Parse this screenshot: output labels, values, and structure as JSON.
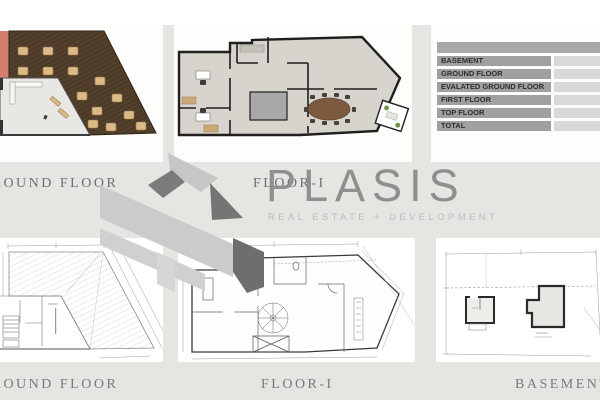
{
  "brand": {
    "name": "PLASIS",
    "tagline": "REAL ESTATE + DEVELOPMENT"
  },
  "top_row_labels": {
    "left": "GROUND FLOOR",
    "middle": "FLOOR-I"
  },
  "bottom_row_labels": {
    "left": "GROUND FLOOR",
    "middle": "FLOOR-I",
    "right": "BASEMENT"
  },
  "area_table": {
    "header": "",
    "rows": [
      {
        "label": "BASEMENT",
        "value": ""
      },
      {
        "label": "GROUND FLOOR",
        "value": ""
      },
      {
        "label": "EVALATED GROUND FLOOR",
        "value": ""
      },
      {
        "label": "FIRST FLOOR",
        "value": ""
      },
      {
        "label": "TOP FLOOR",
        "value": ""
      },
      {
        "label": "TOTAL",
        "value": ""
      }
    ]
  },
  "colors": {
    "page_background": "#e6e5e2",
    "panel_background": "#ffffff",
    "deck_brown": "#53402c",
    "table_tan": "#dcba87",
    "terrace_salmon": "#d2806c",
    "plan_floor_gray": "#d7d3cd",
    "plan_wall_black": "#1f1f1f",
    "conference_table_brown": "#7b5a3f",
    "table_header_gray": "#a9a9a9",
    "table_row_gray": "#a0a0a0",
    "table_value_gray": "#d9d9d8",
    "brand_gray": "#8f8f8f",
    "label_gray": "#6e6e78",
    "logo_light_gray": "#cbcbcb",
    "logo_dark_gray": "#6e6e6e"
  }
}
